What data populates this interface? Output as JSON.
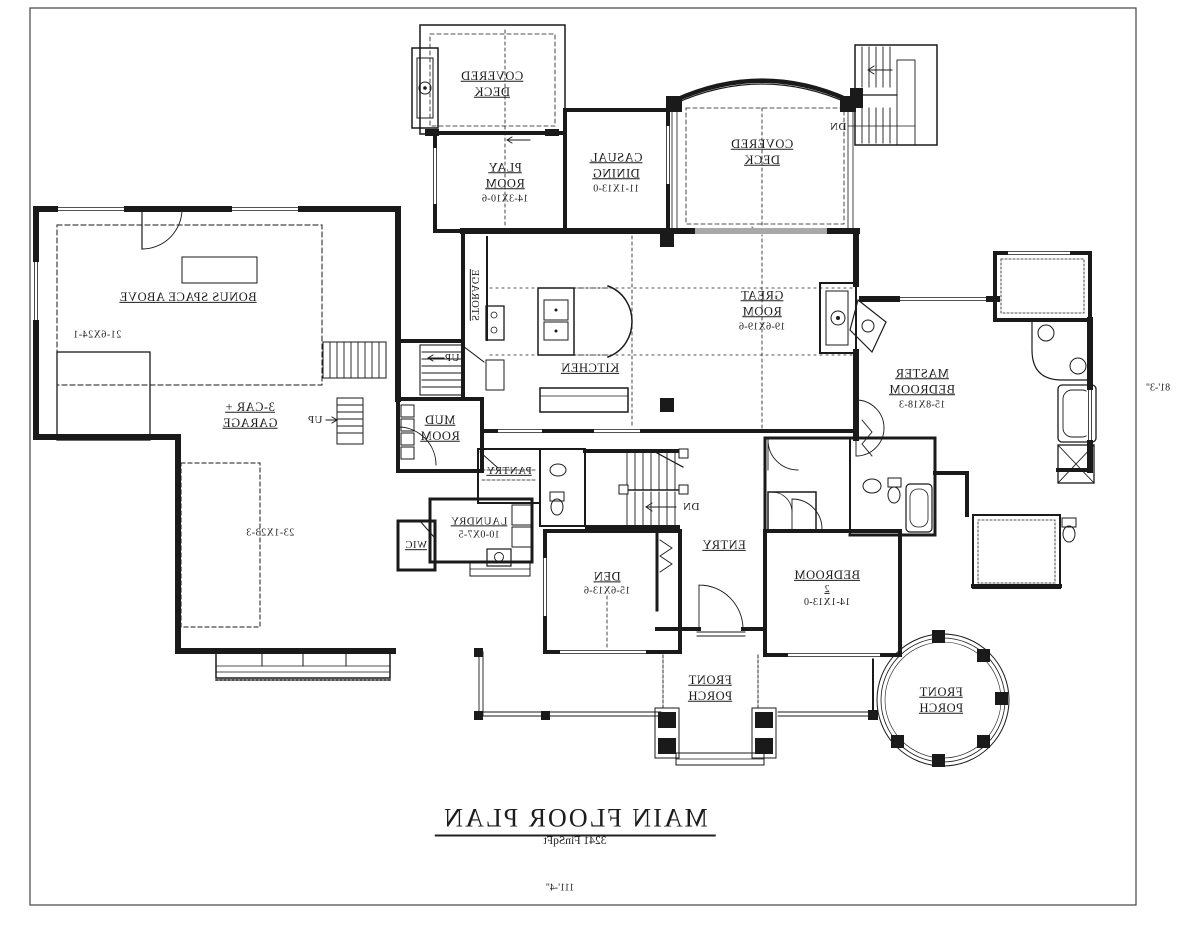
{
  "meta": {
    "drawing_type": "architectural floor plan (mirrored print)"
  },
  "title": {
    "text": "MAIN FLOOR PLAN",
    "subtitle": "3241 FinSqFt"
  },
  "dims": {
    "width": "111'-4\"",
    "height": "81'-3\""
  },
  "rooms": [
    {
      "id": "covered-deck-left",
      "label": "COVERED DECK",
      "dim": ""
    },
    {
      "id": "play-room",
      "label": "PLAY ROOM",
      "dim": "14-3X10-6"
    },
    {
      "id": "casual-dining",
      "label": "CASUAL DINING",
      "dim": "11-1X13-0"
    },
    {
      "id": "covered-deck-right",
      "label": "COVERED DECK",
      "dim": ""
    },
    {
      "id": "great-room",
      "label": "GREAT ROOM",
      "dim": "19-6X19-6"
    },
    {
      "id": "kitchen",
      "label": "KITCHEN",
      "dim": ""
    },
    {
      "id": "storage",
      "label": "STORAGE",
      "dim": ""
    },
    {
      "id": "bonus-space",
      "label": "BONUS SPACE ABOVE",
      "dim": "21-6X24-1"
    },
    {
      "id": "garage",
      "label": "3-CAR + GARAGE",
      "dim": "23-1X23-3"
    },
    {
      "id": "master-bedroom",
      "label": "MASTER BEDROOM",
      "dim": "15-8X18-3"
    },
    {
      "id": "mud-room",
      "label": "MUD ROOM",
      "dim": ""
    },
    {
      "id": "pantry",
      "label": "PANTRY",
      "dim": ""
    },
    {
      "id": "laundry",
      "label": "LAUNDRY",
      "dim": "10-0X7-5"
    },
    {
      "id": "wic",
      "label": "WIC",
      "dim": ""
    },
    {
      "id": "entry",
      "label": "ENTRY",
      "dim": ""
    },
    {
      "id": "den",
      "label": "DEN",
      "dim": "15-6X13-6"
    },
    {
      "id": "bedroom-2",
      "label": "BEDROOM",
      "number": "2",
      "dim": "14-1X13-0"
    },
    {
      "id": "front-porch-center",
      "label": "FRONT PORCH",
      "dim": ""
    },
    {
      "id": "front-porch-round",
      "label": "FRONT PORCH",
      "dim": ""
    }
  ],
  "annotations": {
    "dn_deck": "DN",
    "dn_stair": "DN",
    "up_garage": "UP",
    "up_main": "UP"
  },
  "colors": {
    "ink": "#1a1a1a",
    "paper": "#ffffff"
  }
}
